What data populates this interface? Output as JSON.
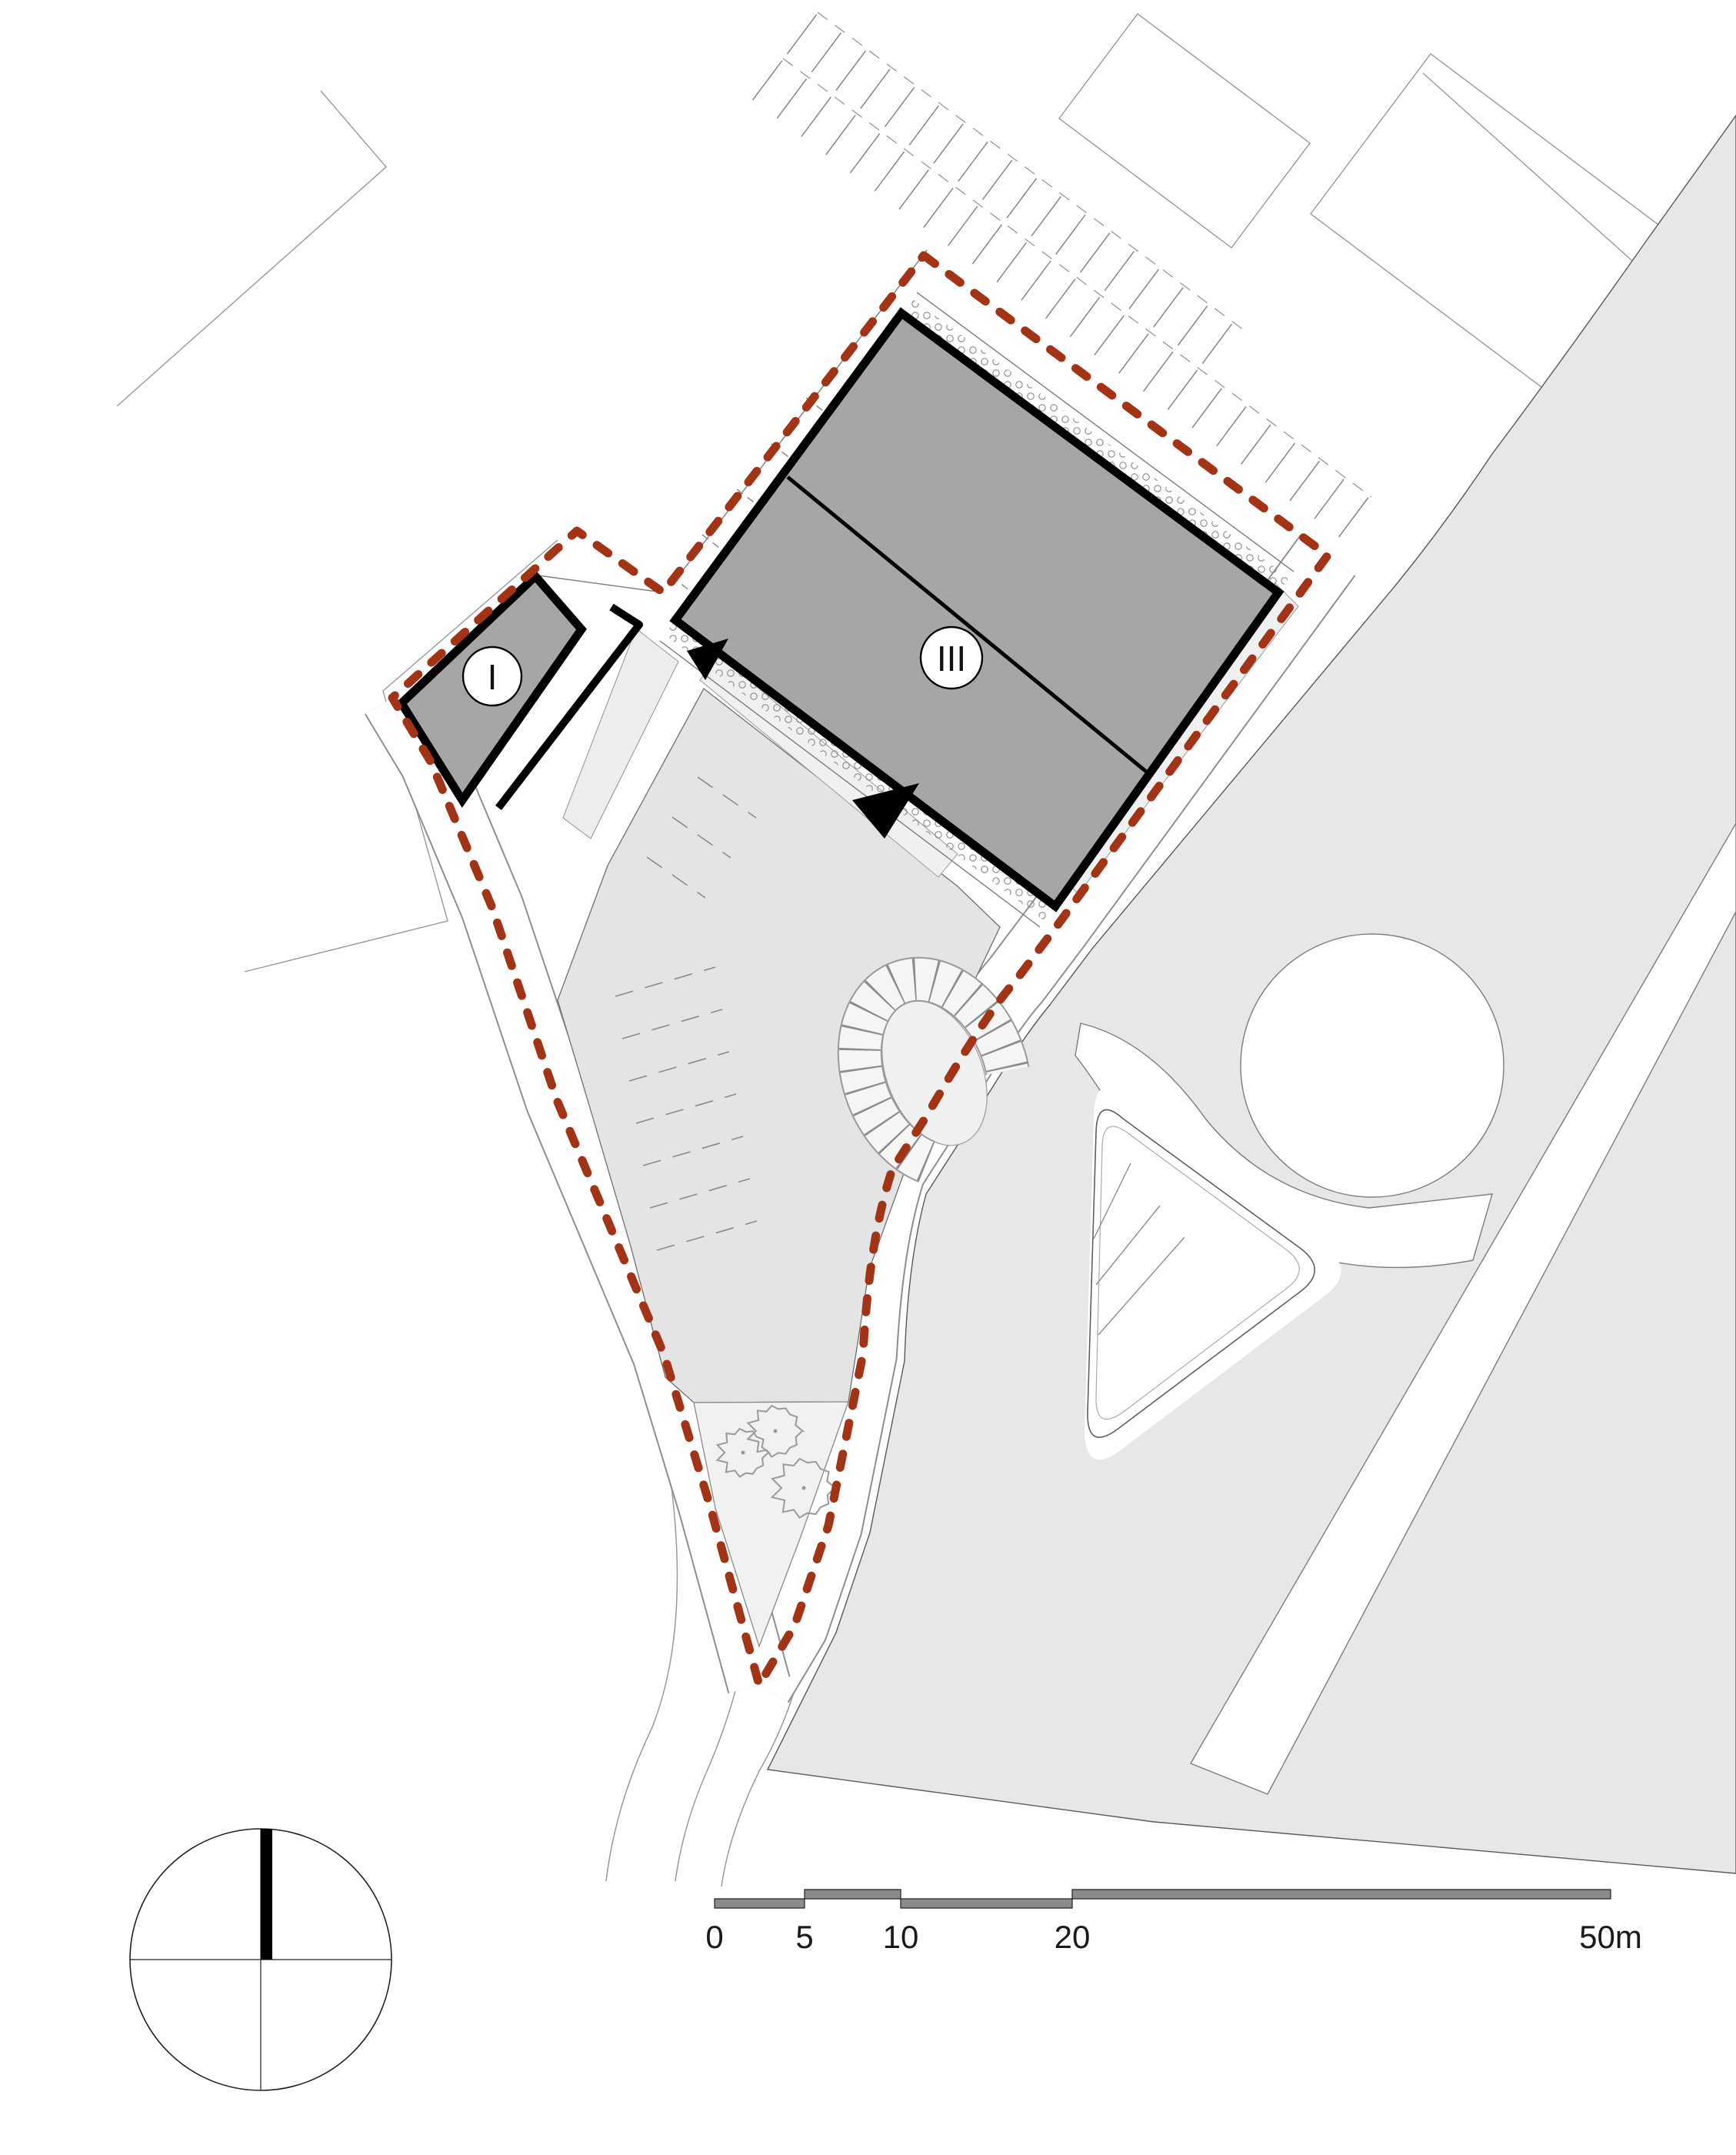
{
  "site": {
    "building_1_label": "I",
    "building_3_label": "III"
  },
  "scale_bar": {
    "tick_0": "0",
    "tick_5": "5",
    "tick_10": "10",
    "tick_20": "20",
    "tick_50": "50m"
  },
  "colors": {
    "boundary_red": "#A23415",
    "building_fill": "#A6A6A6",
    "road_fill": "#E7E7E7",
    "parking_fill": "#E4E4E4",
    "scalebar_fill": "#8A8A8A"
  }
}
